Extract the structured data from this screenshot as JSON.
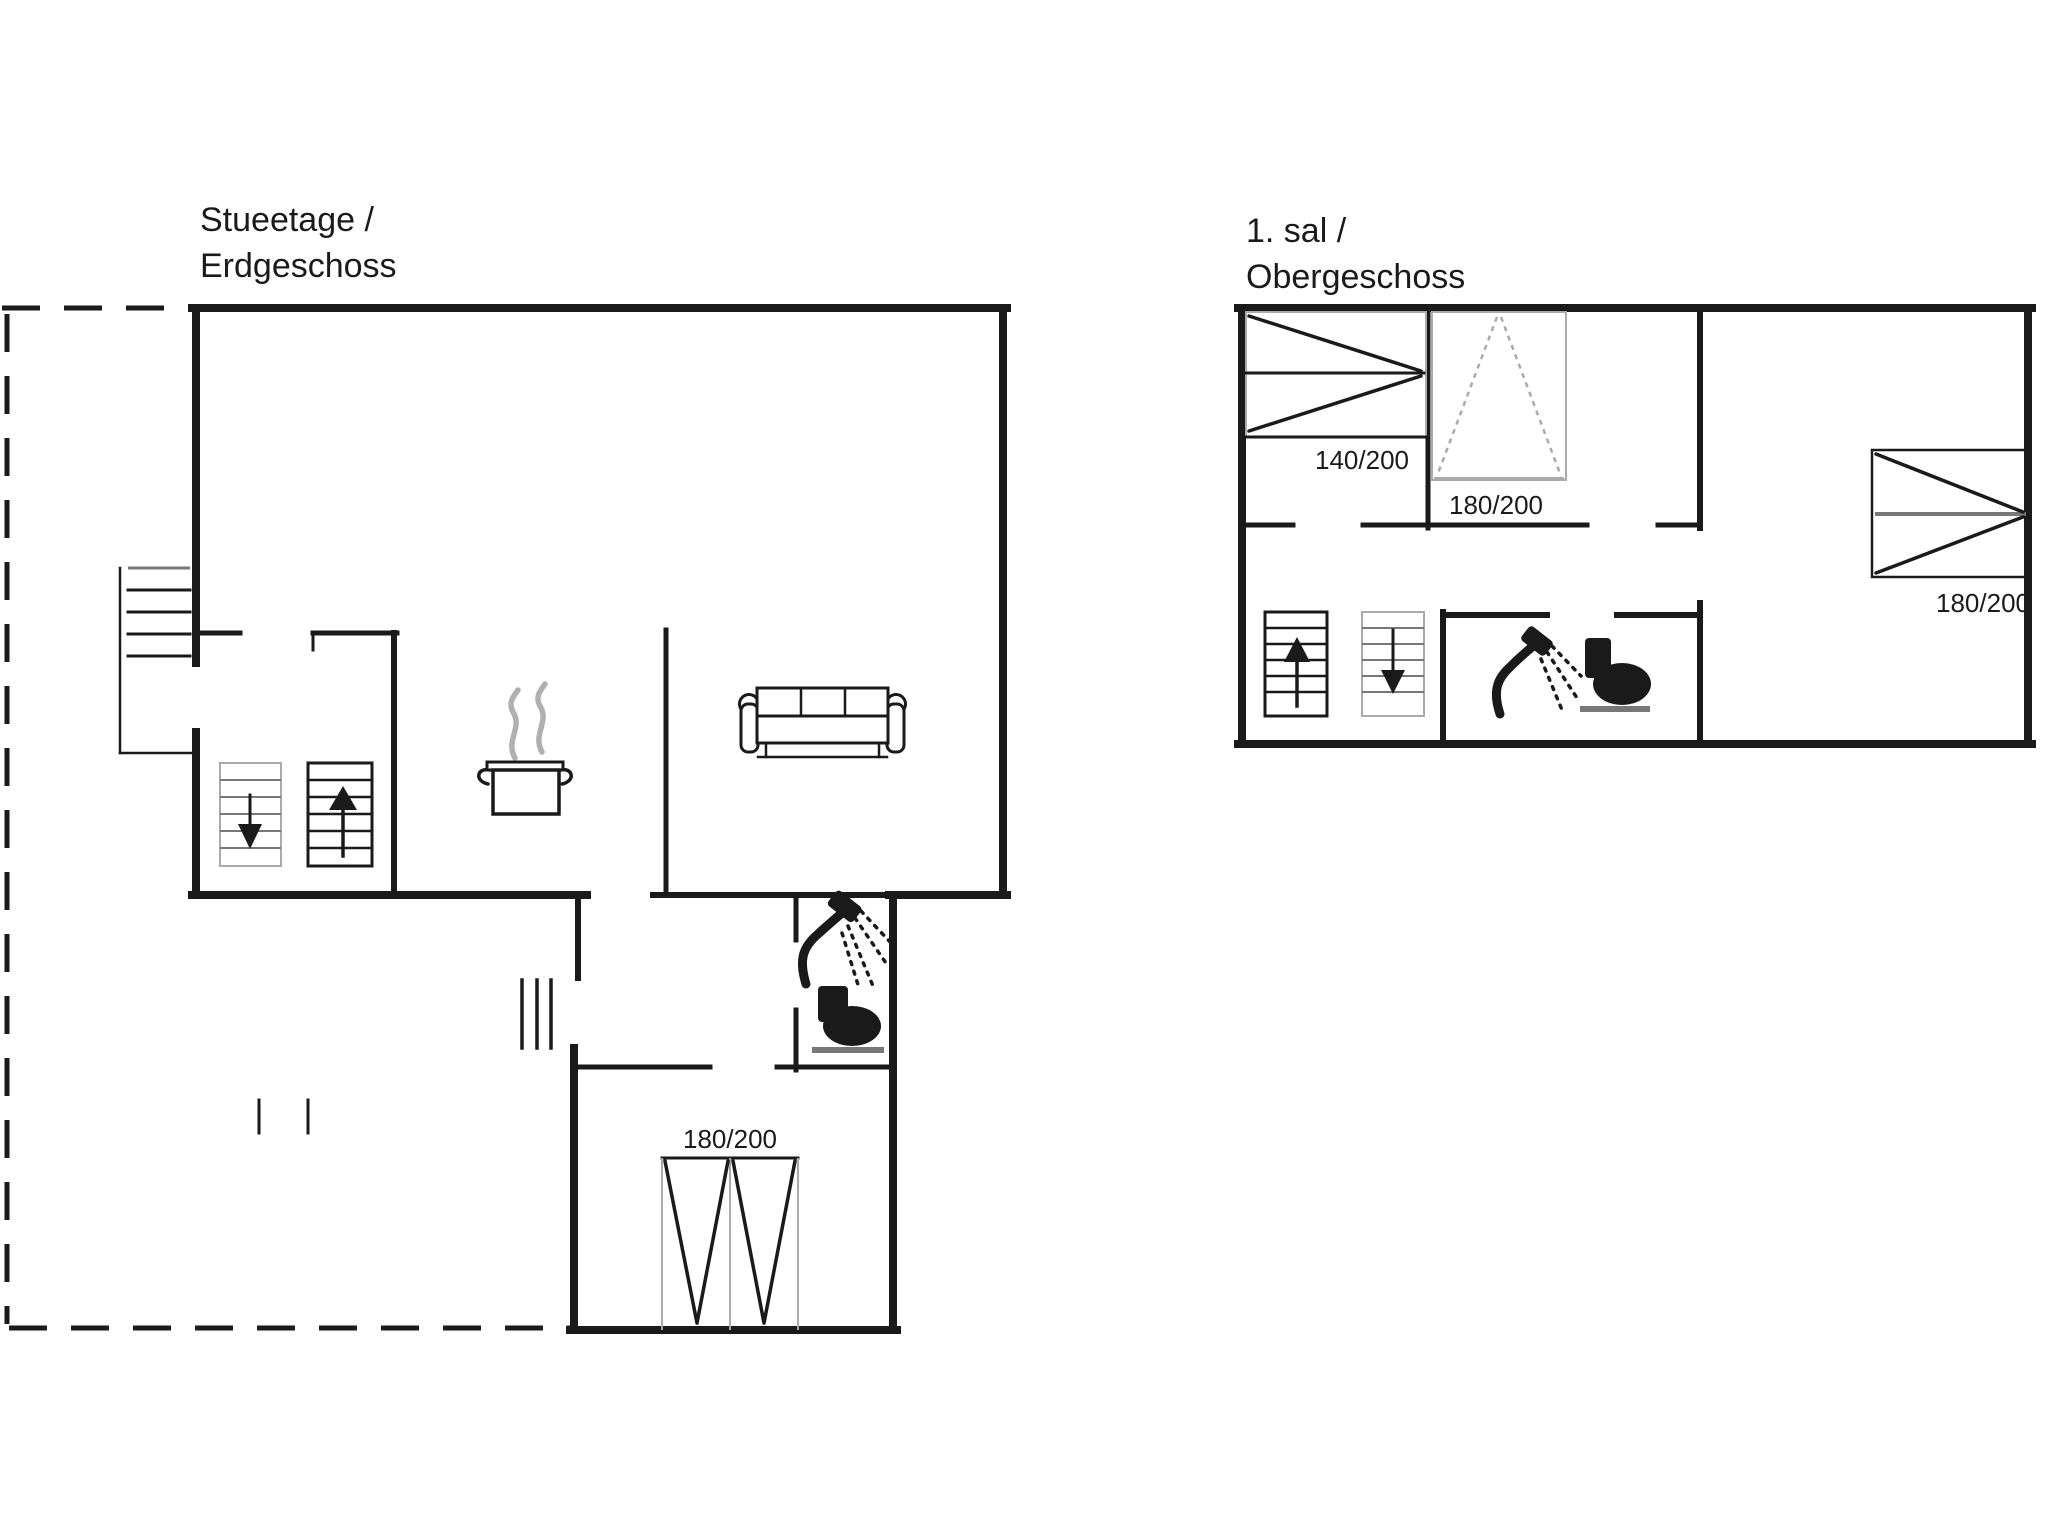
{
  "colors": {
    "ink": "#1a1a1a",
    "mid": "#777777",
    "light": "#aaaaaa",
    "steam": "#b0b0b0"
  },
  "ground_floor_plan": {
    "title_line1": "Stueetage /",
    "title_line2": "Erdgeschoss",
    "bed_label": "180/200"
  },
  "upper_floor_plan": {
    "title_line1": "1. sal /",
    "title_line2": "Obergeschoss",
    "bed_140_label": "140/200",
    "bed_180_left_label": "180/200",
    "bed_180_right_label": "180/200"
  }
}
